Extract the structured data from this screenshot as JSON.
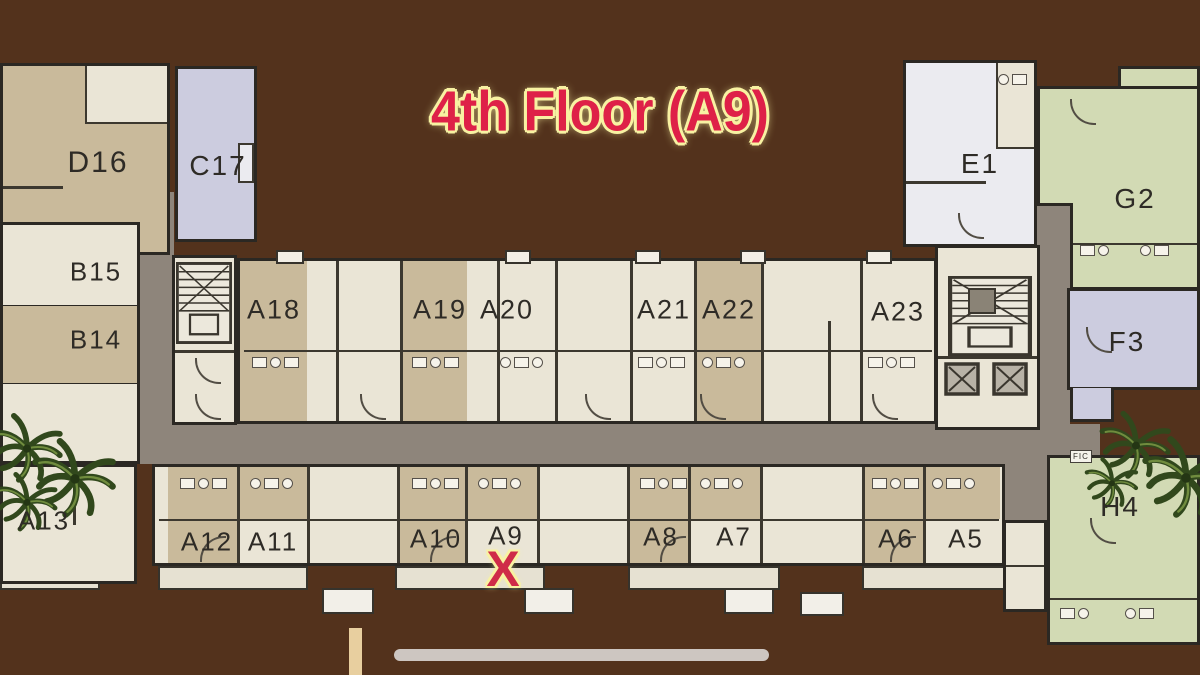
{
  "title": "4th Floor (A9)",
  "marker": {
    "symbol": "X",
    "marked_unit": "A9"
  },
  "unit_labels": {
    "d16": "D16",
    "c17": "C17",
    "b15": "B15",
    "b14": "B14",
    "a13": "A13",
    "a18": "A18",
    "a19": "A19",
    "a20": "A20",
    "a21": "A21",
    "a22": "A22",
    "a23": "A23",
    "a12": "A12",
    "a11": "A11",
    "a10": "A10",
    "a9": "A9",
    "a8": "A8",
    "a7": "A7",
    "a6": "A6",
    "a5": "A5",
    "e1": "E1",
    "g2": "G2",
    "f3": "F3",
    "h4": "H4"
  },
  "small_labels": {
    "fic": "FIC"
  },
  "colors": {
    "title_red": "#de2148",
    "outline_yellow": "#f8f2a2",
    "x_red": "#cf2b48",
    "corridor_gray": "#8e857b",
    "unit_tan": "#c9ba9b",
    "unit_cream": "#eae5d6",
    "unit_lavender": "#ccccdf",
    "unit_green": "#d2dab4",
    "unit_white": "#ebebf0",
    "wall_dark": "#2b2823",
    "wood_brown": "#5e3a21"
  }
}
